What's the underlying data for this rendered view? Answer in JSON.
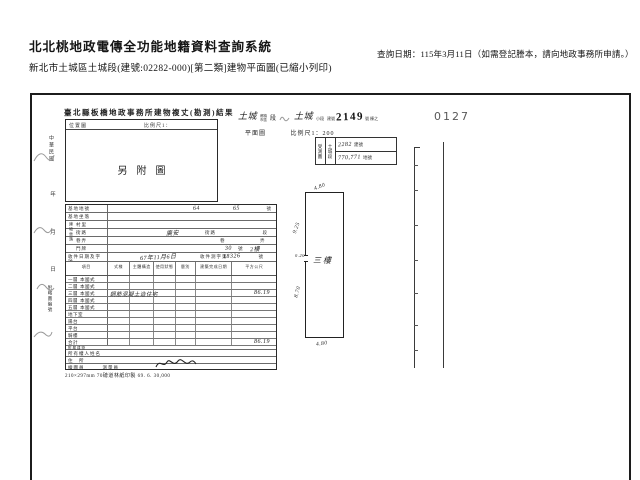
{
  "header": {
    "system_title": "北北桃地政電傳全功能地籍資料查詢系統",
    "subtitle": "新北市土城區土城段(建號:02282-000)[第二類]建物平面圖(已縮小列印)",
    "query_date": "查詢日期：115年3月11日（如需登記謄本，請向地政事務所申請。）"
  },
  "scan": {
    "page_stamp": "0127",
    "form_title": "臺北縣板橋地政事務所建物複丈(勘測)結果",
    "location_box": {
      "label": "位置圖",
      "scale_label": "比例尺1：",
      "content": "另附圖"
    },
    "right_header": {
      "township": "土城",
      "township_label_top": "鄉鎮",
      "township_label_bottom": "市區",
      "section_label": "段",
      "small_section_value": "土城",
      "small_section_label": "小段",
      "building_no_label": "建號",
      "building_no_stamp": "2149",
      "building_no_suffix": "號 棟之",
      "plan_label": "平面圖",
      "plan_scale": "比例尺1：200"
    },
    "ref_stamp": {
      "col1": "受測圖",
      "col2": "土城段",
      "row1_value": "2282",
      "row1_label": "建號",
      "row2_value": "770,771",
      "row2_label": "地號"
    },
    "margin": {
      "era": "中華民國",
      "year": "年",
      "month": "月",
      "day": "日",
      "note": "附略圖編號"
    },
    "form": {
      "group_label": "建物坐落",
      "site_rows": [
        {
          "label": "基地地號",
          "value": "64",
          "value2": "65",
          "printed": "",
          "suffix": "號"
        },
        {
          "label": "基地坐落",
          "value": "",
          "value2": "",
          "printed": "",
          "suffix": ""
        },
        {
          "label": "村里",
          "value": "",
          "value2": "",
          "printed": "",
          "suffix": ""
        },
        {
          "label": "街路",
          "value": "廣安",
          "value2": "",
          "printed": "街路",
          "suffix": "段"
        },
        {
          "label": "巷弄",
          "value": "",
          "value2": "",
          "printed": "巷",
          "suffix": "弄"
        },
        {
          "label": "門牌",
          "value": "30",
          "value2": "2樓",
          "printed": "號",
          "suffix": ""
        },
        {
          "label": "收件日期及字號",
          "value": "67年11月6日",
          "value2": "18326",
          "printed": "收件測字第",
          "suffix": "號"
        }
      ],
      "columns": [
        "項目",
        "式樣",
        "主體構造",
        "使用狀態",
        "層別",
        "建築完成日期",
        "平方公尺"
      ],
      "floor_rows": [
        {
          "label": "一層",
          "style": "本國式",
          "entry": "",
          "area": ""
        },
        {
          "label": "二層",
          "style": "本國式",
          "entry": "",
          "area": ""
        },
        {
          "label": "三層",
          "style": "本國式",
          "entry": "鋼筋混凝土造住宅",
          "area": "86.19"
        },
        {
          "label": "四層",
          "style": "本國式",
          "entry": "",
          "area": ""
        },
        {
          "label": "五層",
          "style": "本國式",
          "entry": "",
          "area": ""
        },
        {
          "label": "地下室",
          "style": "",
          "entry": "",
          "area": ""
        },
        {
          "label": "陽台",
          "style": "",
          "entry": "",
          "area": ""
        },
        {
          "label": "平台",
          "style": "",
          "entry": "",
          "area": ""
        },
        {
          "label": "騎樓",
          "style": "",
          "entry": "",
          "area": ""
        },
        {
          "label": "合計",
          "style": "",
          "entry": "",
          "area": "86.19"
        }
      ],
      "bottom_rows": [
        {
          "label": "附屬建物"
        },
        {
          "label": "所有權人姓名"
        },
        {
          "label": "住　所"
        },
        {
          "label": "繪圖員",
          "extra": "測量員"
        }
      ],
      "footer_note": "210×297mm 70磅道林紙印製 69. 6. 30,000"
    },
    "drawing": {
      "room_label": "三樓",
      "dim_top": "4.80",
      "dim_left_upper": "9.25",
      "dim_left_mid": "0.20",
      "dim_left_lower": "8.70",
      "dim_bottom": "4.80"
    }
  }
}
